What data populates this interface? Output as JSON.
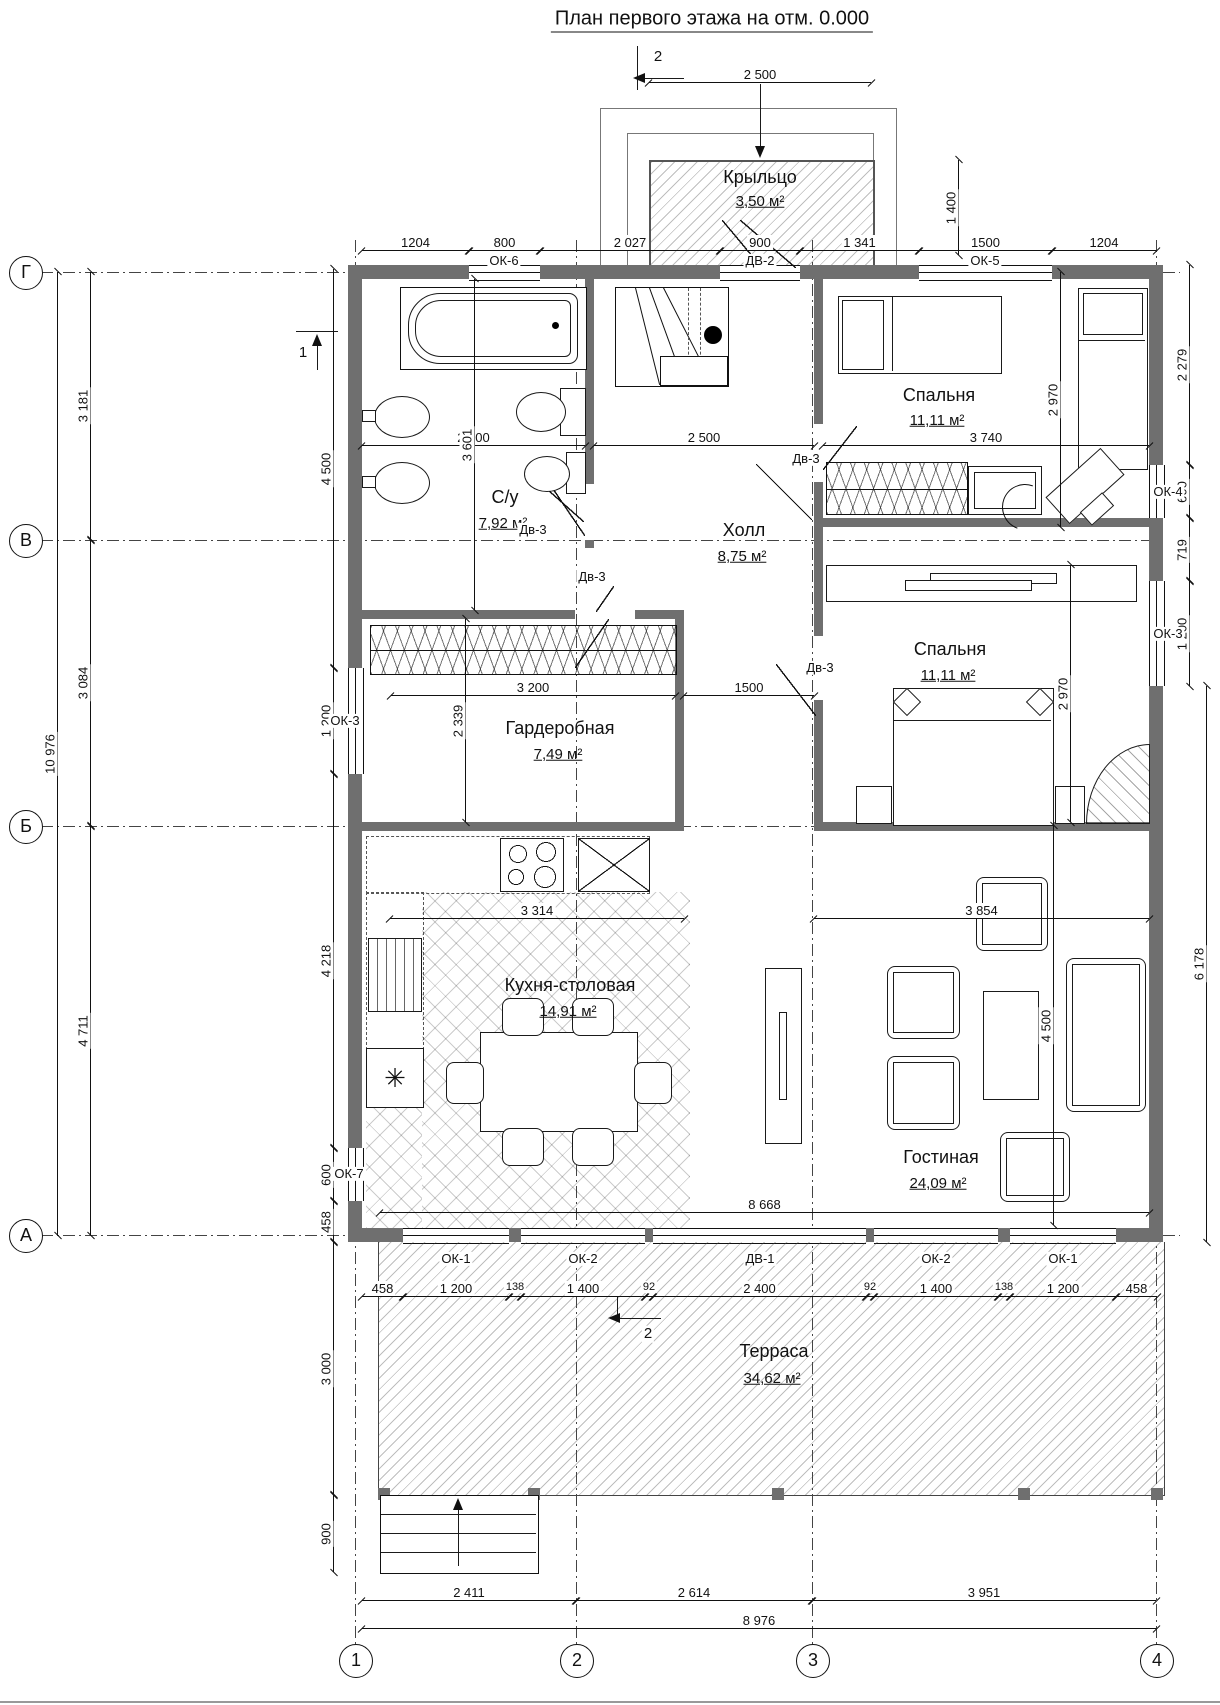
{
  "title": "План первого этажа на отм. 0.000",
  "rooms": {
    "porch": {
      "name": "Крыльцо",
      "area": "3,50 м²"
    },
    "bedroom1": {
      "name": "Спальня",
      "area": "11,11 м²"
    },
    "bathroom": {
      "name": "С/у",
      "area": "7,92 м²"
    },
    "hall": {
      "name": "Холл",
      "area": "8,75 м²"
    },
    "wardrobe": {
      "name": "Гардеробная",
      "area": "7,49 м²"
    },
    "bedroom2": {
      "name": "Спальня",
      "area": "11,11 м²"
    },
    "kitchen": {
      "name": "Кухня-столовая",
      "area": "14,91 м²"
    },
    "living": {
      "name": "Гостиная",
      "area": "24,09 м²"
    },
    "terrace": {
      "name": "Терраса",
      "area": "34,62 м²"
    }
  },
  "axes": {
    "row1": "Г",
    "row2": "В",
    "row3": "Б",
    "row4": "А",
    "col1": "1",
    "col2": "2",
    "col3": "3",
    "col4": "4"
  },
  "sections": {
    "s1": "1",
    "s2": "2"
  },
  "dims": {
    "top_2500": "2 500",
    "top_1400": "1 400",
    "top_1204a": "1204",
    "top_800": "800",
    "top_2027": "2 027",
    "top_900": "900",
    "top_1341": "1 341",
    "top_1500": "1500",
    "top_1204b": "1204",
    "left_10976": "10 976",
    "left_3181": "3 181",
    "left_3084": "3 084",
    "left_4711": "4 711",
    "left_4500": "4 500",
    "left_1200": "1 200",
    "left_4218": "4 218",
    "left_600": "600",
    "left_458": "458",
    "left_3000": "3 000",
    "left_900": "900",
    "right_2279": "2 279",
    "right_600": "600",
    "right_719": "719",
    "right_1200": "1 200",
    "right_6178": "6 178",
    "b1_2970": "2 970",
    "b1_3740": "3 740",
    "b2_2970": "2 970",
    "bath_2200": "2 200",
    "bath_3601": "3 601",
    "hall_2500": "2 500",
    "ward_3200": "3 200",
    "ward_2339": "2 339",
    "corr_1500": "1500",
    "kit_3314": "3 314",
    "liv_3854": "3 854",
    "liv_4500": "4 500",
    "liv_8668": "8 668",
    "bot_458a": "458",
    "bot_1200a": "1 200",
    "bot_138a": "138",
    "bot_1400a": "1 400",
    "bot_92a": "92",
    "bot_2400": "2 400",
    "bot_92b": "92",
    "bot_1400b": "1 400",
    "bot_138b": "138",
    "bot_1200b": "1 200",
    "bot_458b": "458",
    "bot_2411": "2 411",
    "bot_2614": "2 614",
    "bot_3951": "3 951",
    "bot_8976": "8 976"
  },
  "tags": {
    "ok6": "ОК-6",
    "dv2": "ДВ-2",
    "ok5": "ОК-5",
    "ok4": "ОК-4",
    "ok3r": "ОК-3",
    "ok3l": "ОК-3",
    "ok7": "ОК-7",
    "ok1a": "ОК-1",
    "ok2a": "ОК-2",
    "dv1": "ДВ-1",
    "ok2b": "ОК-2",
    "ok1b": "ОК-1",
    "dv3_bath": "Дв-3",
    "dv3_bed1": "Дв-3",
    "dv3_ward": "Дв-3",
    "dv3_bed2": "Дв-3"
  },
  "icons": {
    "snowflake": "✳"
  }
}
